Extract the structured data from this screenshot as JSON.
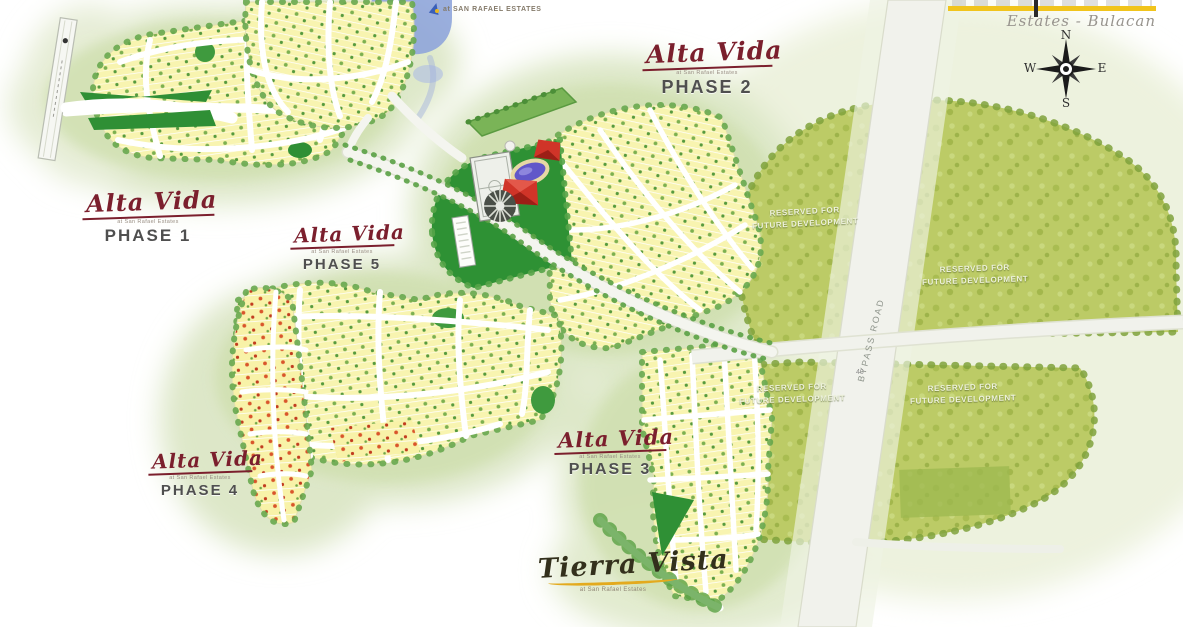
{
  "brand_right": {
    "estates_line": "Estates - Bulacan"
  },
  "brand_center": {
    "text": "at SAN RAFAEL ESTATES"
  },
  "compass": {
    "n": "N",
    "e": "E",
    "s": "S",
    "w": "W"
  },
  "phase_labels": {
    "script": "Alta Vida",
    "subtext": "at San Rafael Estates",
    "phases": [
      "PHASE 1",
      "PHASE 2",
      "PHASE 3",
      "PHASE 4",
      "PHASE 5"
    ]
  },
  "tierra_vista": {
    "script": "Tierra Vista",
    "subtext": "at San Rafael Estates"
  },
  "reserved_label": {
    "line1": "RESERVED FOR",
    "line2": "FUTURE DEVELOPMENT"
  },
  "roads": {
    "bypass": "BYPASS ROAD",
    "lot_marking": "40"
  },
  "colors": {
    "accent_yellow": "#F1C41C",
    "maroon": "#7B1F2D",
    "lot_yellow": "#F7F3AF",
    "olive": "#BCCB66",
    "park_green": "#2E9134",
    "water_blue": "#8FA5DA"
  }
}
